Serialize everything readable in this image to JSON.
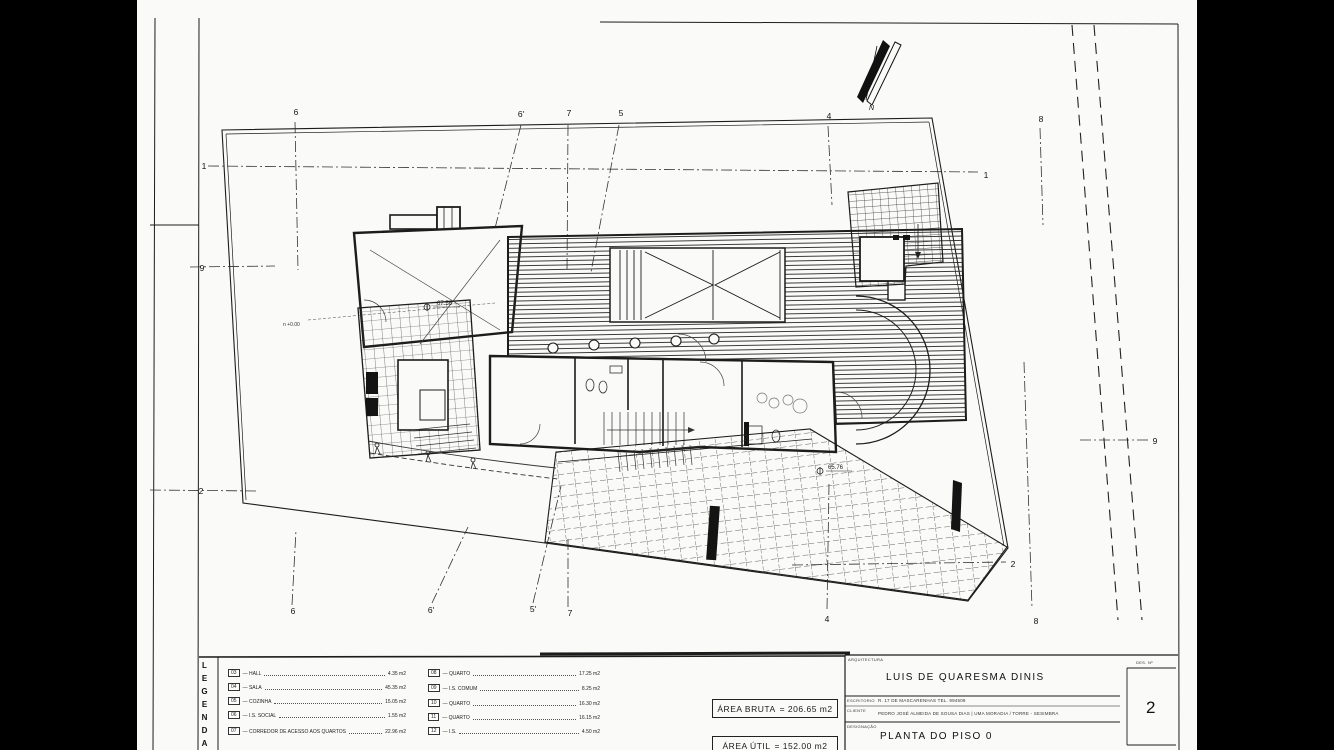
{
  "drawing": {
    "north_label": "N",
    "grid": {
      "t6": "6",
      "t6p": "6'",
      "t7": "7",
      "t5": "5",
      "t4": "4",
      "t8": "8",
      "b6": "6",
      "b6p": "6'",
      "b5p": "5'",
      "b7": "7",
      "b4": "4",
      "b8": "8",
      "l1": "1",
      "l9": "9",
      "l2": "2",
      "r1": "1",
      "r9": "9",
      "r2": "2"
    },
    "annotations": {
      "level_main": "67.56",
      "level_patio": "65.76",
      "level_zero": "n +0.00"
    }
  },
  "legend": {
    "title": "LEGENDA",
    "items_left": [
      {
        "num": "03",
        "name": "— HALL",
        "area": "4.35 m2"
      },
      {
        "num": "04",
        "name": "— SALA",
        "area": "45.35 m2"
      },
      {
        "num": "05",
        "name": "— COZINHA",
        "area": "15.05 m2"
      },
      {
        "num": "06",
        "name": "— I.S. SOCIAL",
        "area": "1.55 m2"
      },
      {
        "num": "07",
        "name": "— CORREDOR DE ACESSO AOS QUARTOS",
        "area": "22.96 m2"
      }
    ],
    "items_right": [
      {
        "num": "08",
        "name": "— QUARTO",
        "area": "17.25 m2"
      },
      {
        "num": "09",
        "name": "— I.S. COMUM",
        "area": "8.25 m2"
      },
      {
        "num": "10",
        "name": "— QUARTO",
        "area": "16.30 m2"
      },
      {
        "num": "11",
        "name": "— QUARTO",
        "area": "16.15 m2"
      },
      {
        "num": "12",
        "name": "— I.S.",
        "area": "4.50 m2"
      }
    ]
  },
  "areas": {
    "bruta_label": "ÁREA BRUTA",
    "bruta_value": "= 206.65 m2",
    "util_label": "ÁREA ÚTIL",
    "util_value": "= 152.00 m2"
  },
  "title_block": {
    "section_label": "ARQUITECTURA",
    "architect": "LUIS DE QUARESMA DINIS",
    "office_label": "ESCRITORIO",
    "office": "R. 17 DE MASCARENHAS  TEL. 994509",
    "client_label": "CLIENTE",
    "client": "PEDRO JOSÉ ALMEIDA DE SOUSA DIAS | UMA MORADIA / TORRE - SESIMBRA",
    "designation_label": "DESIGNAÇÃO",
    "designation": "PLANTA DO PISO 0",
    "sheet_label": "DES. Nº",
    "sheet_number": "2"
  }
}
